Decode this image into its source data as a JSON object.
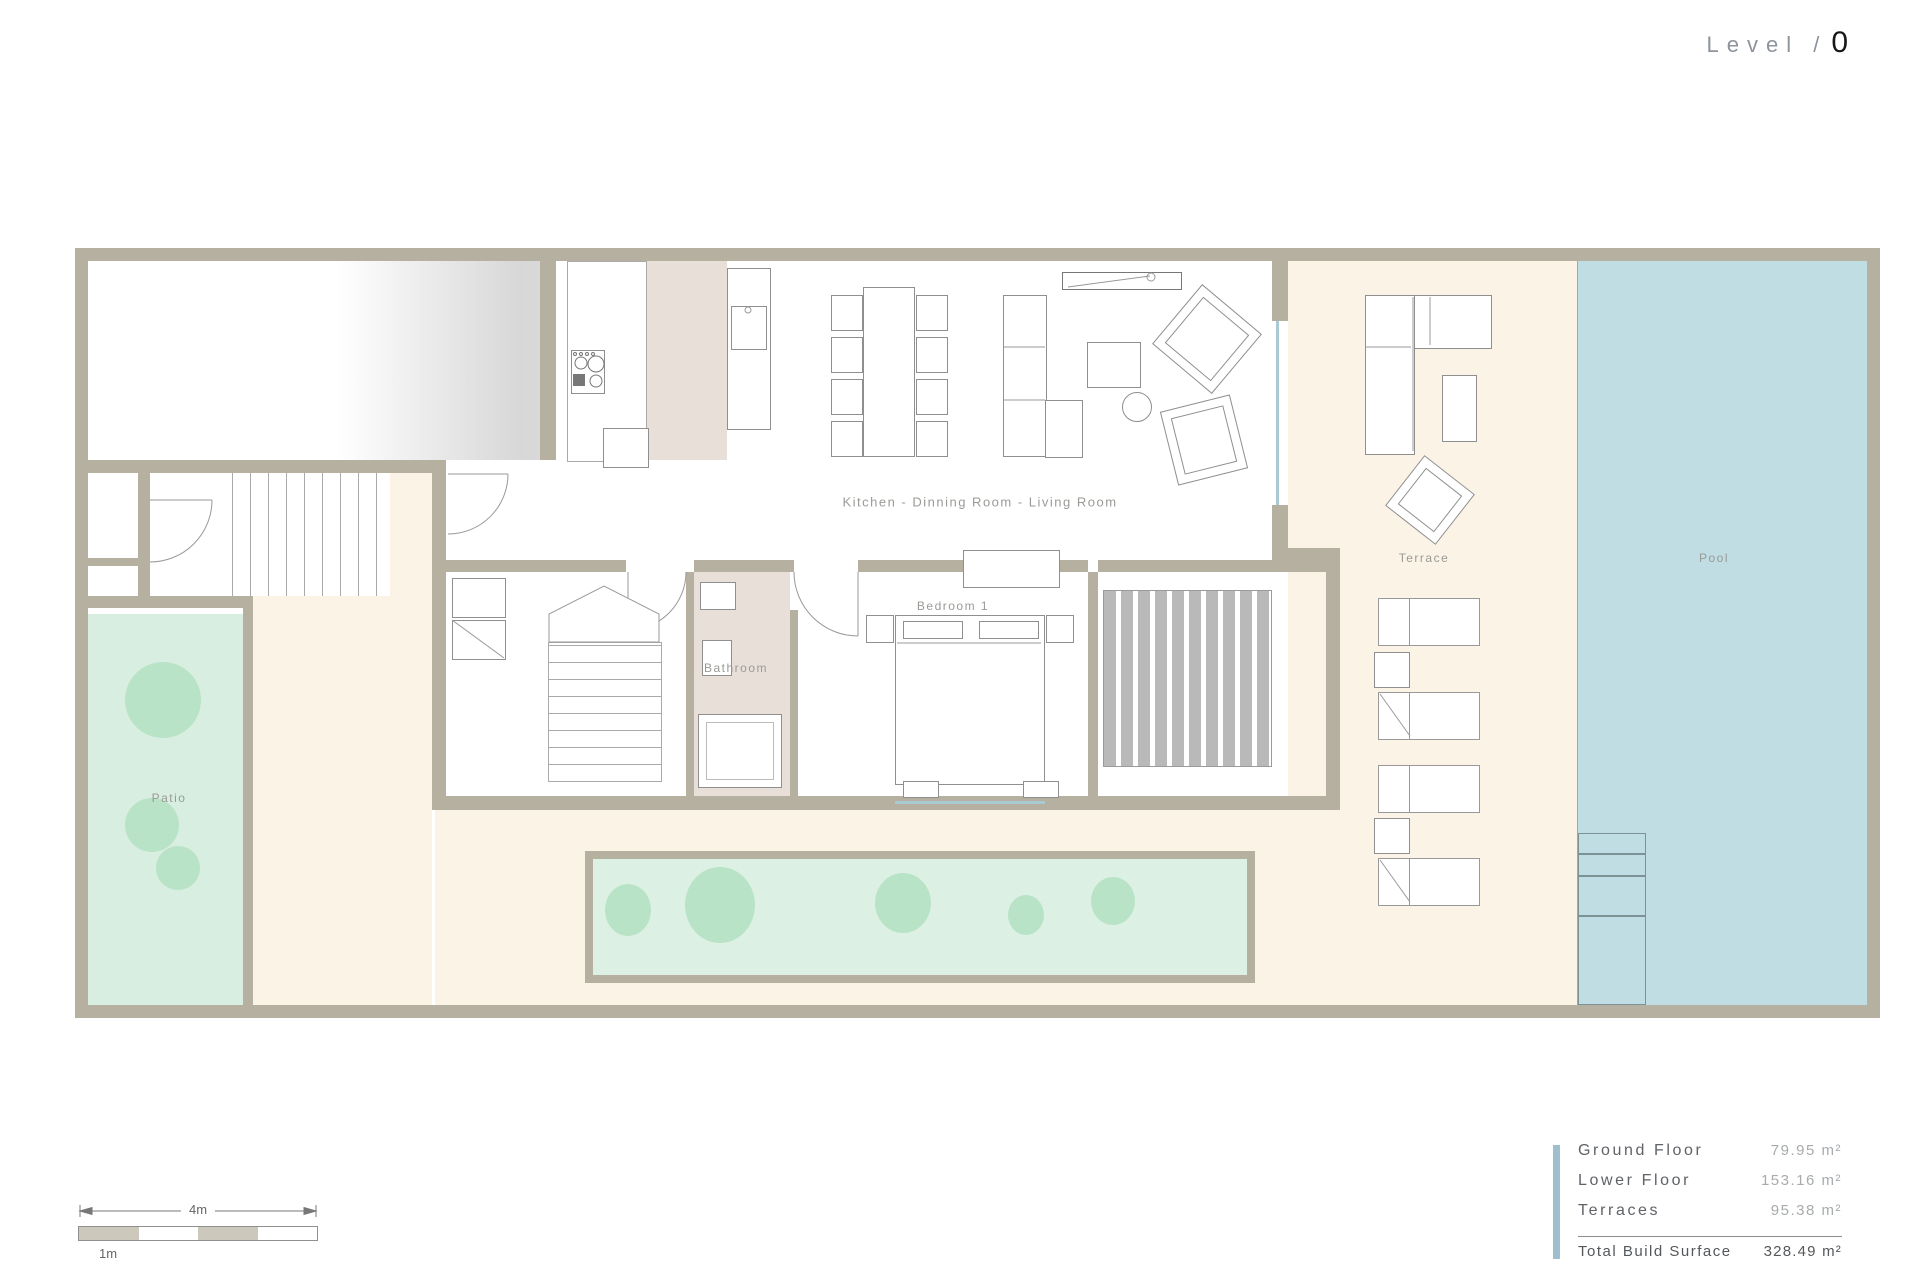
{
  "title": {
    "prefix": "Level /",
    "number": "0"
  },
  "rooms": {
    "kitchen_living": "Kitchen - Dinning Room - Living Room",
    "bedroom": "Bedroom 1",
    "bathroom": "Bathroom",
    "patio": "Patio",
    "terrace": "Terrace",
    "pool": "Pool"
  },
  "scale": {
    "total_label": "4m",
    "segment_label": "1m"
  },
  "legend": {
    "rows": [
      {
        "label": "Ground Floor",
        "value": "79.95",
        "unit": "m²"
      },
      {
        "label": "Lower Floor",
        "value": "153.16",
        "unit": "m²"
      },
      {
        "label": "Terraces",
        "value": "95.38",
        "unit": "m²"
      }
    ],
    "total": {
      "label": "Total Build Surface",
      "value": "328.49",
      "unit": "m²"
    }
  },
  "colors": {
    "wall": "#b6b0a1",
    "pool_blue": "#bfdde2",
    "patio_green": "#d8eee1",
    "planter_green": "#ddf0e4",
    "bush_green": "#b9e3c6",
    "terrace_cream": "#fcf3e7",
    "interior_floor_pink": "#e9dfd9",
    "deck_stripe_gray": "#b9b9b9",
    "legend_accent": "#9cc0cd"
  }
}
